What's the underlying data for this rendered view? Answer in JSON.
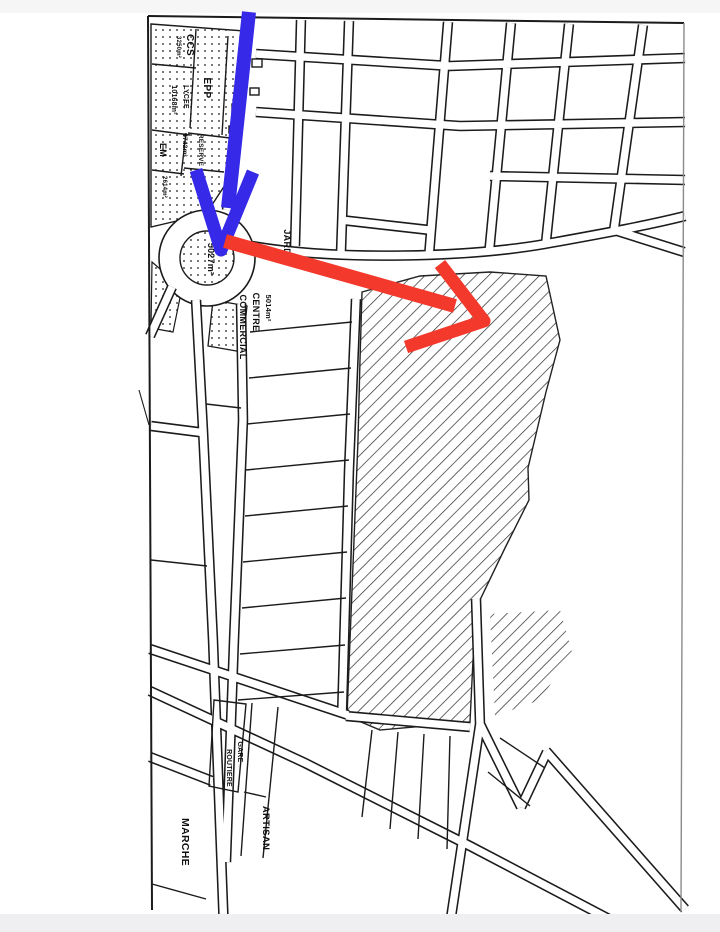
{
  "map": {
    "zones": {
      "ccs_label": "CCS",
      "ccs_area": "3250m²",
      "lycee_label": "LYCEE",
      "lycee_area": "10168m²",
      "epp_label": "EPP",
      "em_label": "EM",
      "em_area": "2614m²",
      "reserve_label": "RESERVE",
      "parcel_area": "4742m²",
      "roundabout_area": "5027m²",
      "jardin_label": "JARDIN",
      "centre_area": "5014m²",
      "centre_label": "CENTRE",
      "commercial_label": "COMMERCIAL",
      "gare_label": "GARE",
      "routiere_label": "ROUTIERE",
      "artisan_label": "ARTISAN",
      "marche_label": "MARCHE"
    },
    "annotations": {
      "blue_arrow_color": "#3629e8",
      "red_arrow_color": "#f2392c"
    },
    "ink_color": "#1b1b1b",
    "page_edge_color": "#f2f2f3"
  }
}
